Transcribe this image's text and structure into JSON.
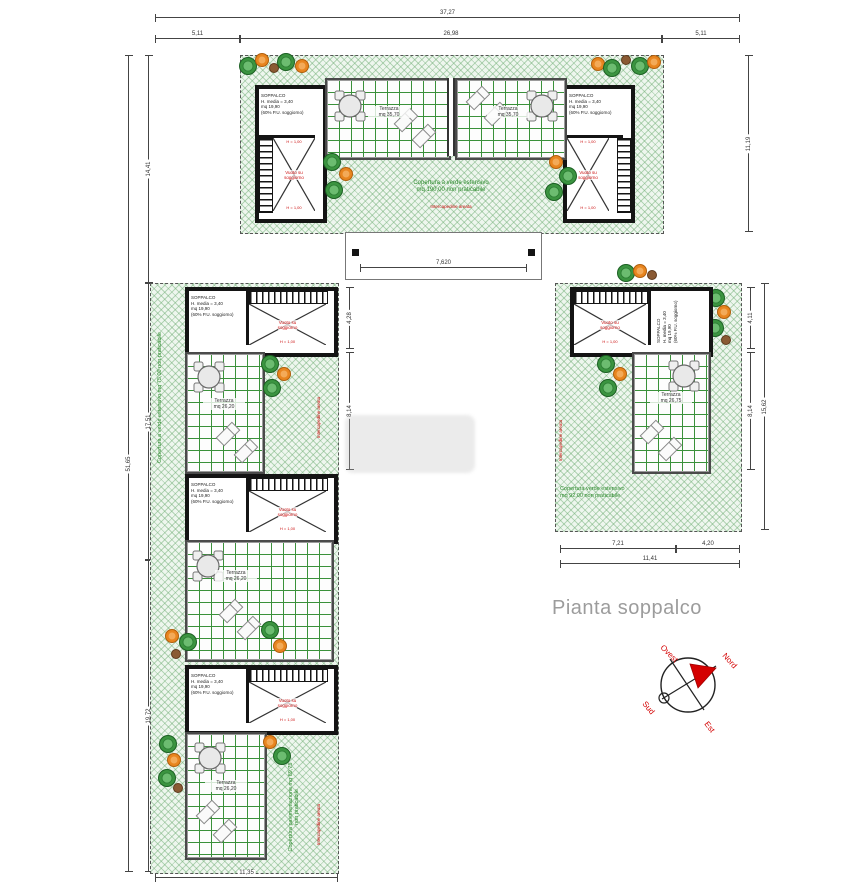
{
  "title": "Pianta soppalco",
  "compass": {
    "north": "Nord",
    "south": "Sud",
    "east": "Est",
    "west": "Ovest"
  },
  "soppalco": {
    "name": "SOPPALCO",
    "l2": "H. media = 3,40",
    "l3": "mq 19,90",
    "l4": "(60% P.U. soggiorno)"
  },
  "void_label": {
    "l1": "Vuoto su",
    "l2": "soggiorno"
  },
  "parapet_label": "H = 1,00",
  "terraces": {
    "top": {
      "l1": "Terrazza",
      "l2": "mq 35,70"
    },
    "wing": {
      "l1": "Terrazza",
      "l2": "mq 26,20"
    },
    "right": {
      "l1": "Terrazza",
      "l2": "mq 26,75"
    }
  },
  "areas": {
    "top_l1": "Copertura a verde estensivo",
    "top_l2": "mq 190,00 non praticabile",
    "left": "Copertura a verde estensivo mq 75,00 non praticabile",
    "center": "Copertura verde estensivo mq 39,00 non praticabile",
    "right_l1": "Copertura verde estensivo",
    "right_l2": "mq 92,00 non praticabile",
    "bottom": "Copertura pavimentazione mq 89,75 non praticabile",
    "note": "Intercapedine areata"
  },
  "dims": {
    "top_total": "37,27",
    "top_l": "5,11",
    "top_m": "26,98",
    "top_r": "5,11",
    "left_total": "51,65",
    "left_s1": "14,41",
    "left_s2": "17,51",
    "left_s3": "19,72",
    "right_top": "11,19",
    "court": "7,620",
    "lw_core": "4,28",
    "lw_terr": "8,14",
    "rw_core": "4,11",
    "rw_terr": "8,14",
    "rw_side": "15,62",
    "rw_b1": "7,21",
    "rw_b2": "4,20",
    "rw_btotal": "11,41",
    "bottom_left": "11,35"
  },
  "colors": {
    "roof_green": "#eef6ee",
    "grid_green": "#3a913a",
    "annotation_red": "#cc1111",
    "text_green": "#2c8a2c",
    "title_gray": "#9c9c9c"
  }
}
